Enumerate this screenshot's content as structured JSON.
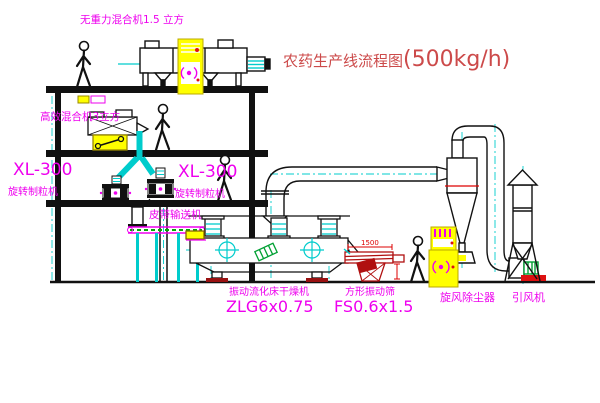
{
  "title": {
    "name": "农药生产线流程图",
    "capacity": "(500kg/h)"
  },
  "machines": {
    "gravity_free_mixer": "无重力混合机1.5 立方",
    "high_efficiency_mixer": "高效混合机3立方",
    "granulator_left_model": "XL-300",
    "granulator_left_name": "旋转制粒机",
    "granulator_right_model": "XL-300",
    "granulator_right_name": "旋转制粒机",
    "belt_conveyor": "皮带输送机",
    "dryer_name": "振动流化床干燥机",
    "dryer_model": "ZLG6x0.75",
    "screen_name": "方形振动筛",
    "screen_model": "FS0.6x1.5",
    "cyclone_name": "旋风除尘器",
    "fan_name": "引风机"
  },
  "dimensions": {
    "screen_width": "1500"
  },
  "colors": {
    "label_magenta": "#EE00EE",
    "title_red": "#CC4A4A",
    "cad_cyan": "#00CCCC",
    "cabinet_yellow": "#FFFF00",
    "alarm_red": "#DD1111",
    "motor_green": "#00A033",
    "line_black": "#111111",
    "screen_dark_red": "#B01010"
  }
}
